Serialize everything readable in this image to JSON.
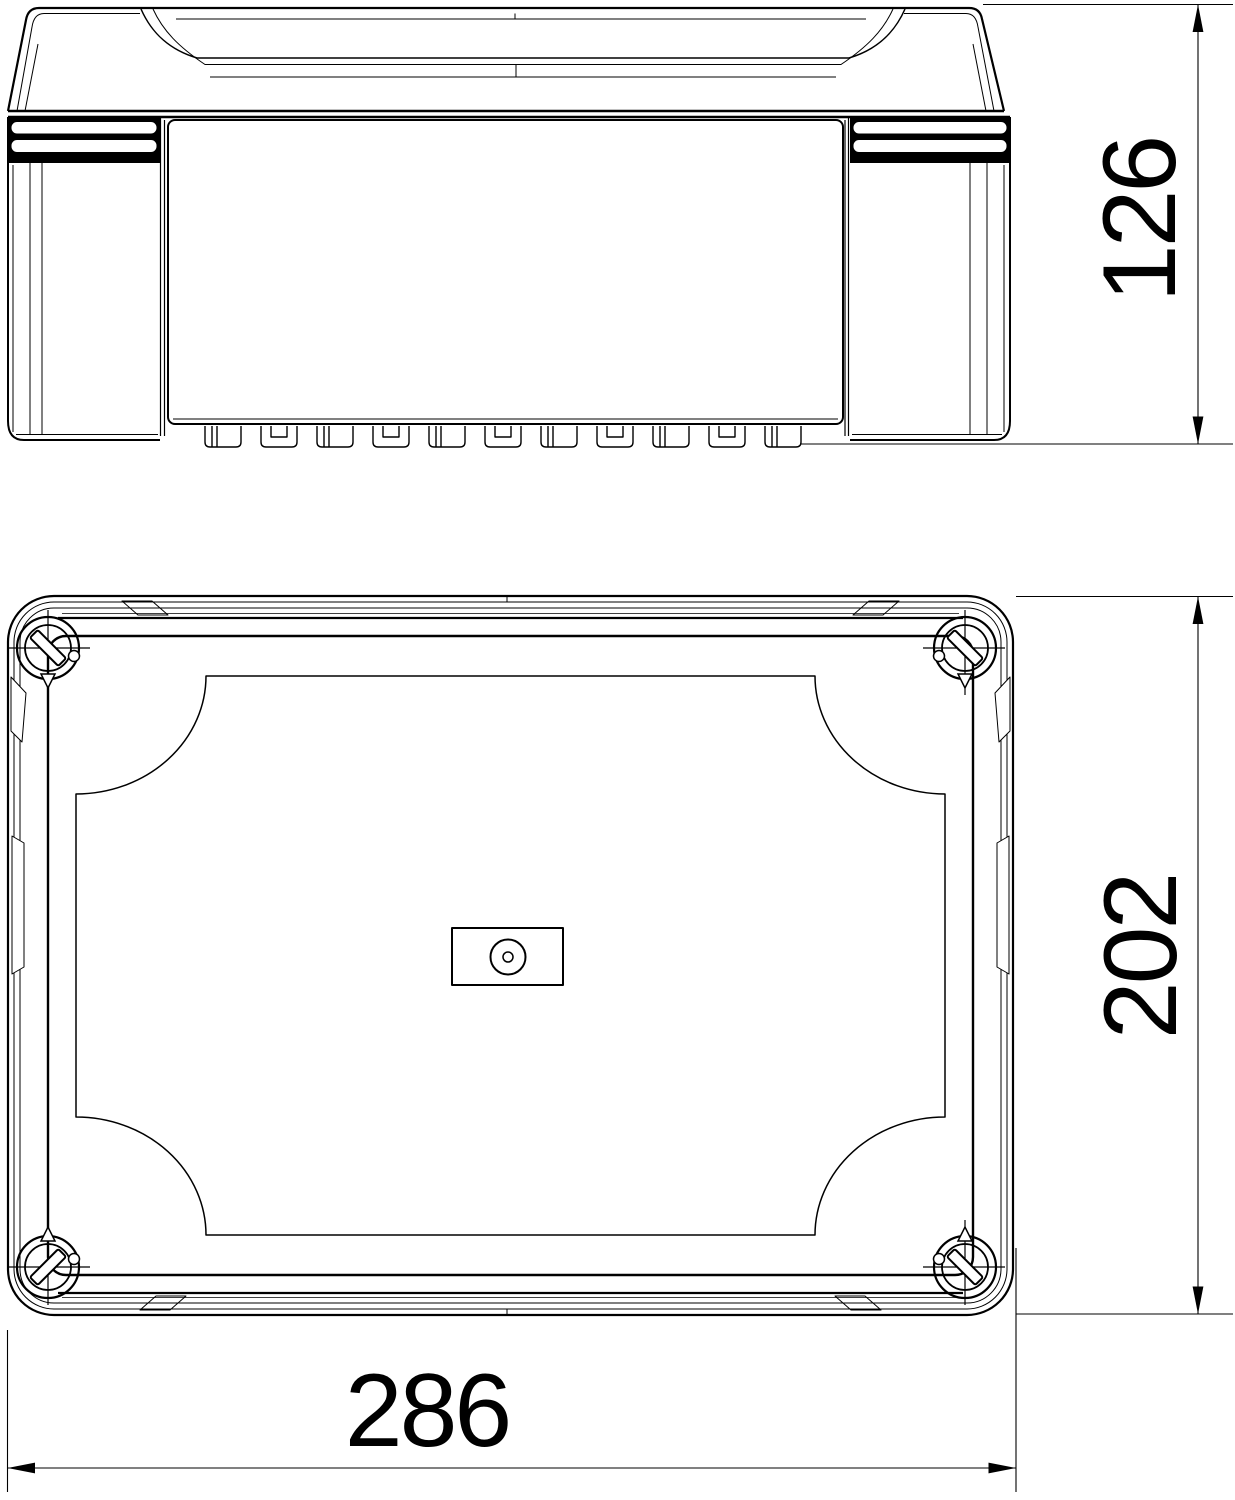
{
  "colors": {
    "line": "#000000",
    "background": "#ffffff"
  },
  "views": {
    "front": {
      "name": "front elevation of enclosure"
    },
    "plan": {
      "name": "plan view of enclosure cover"
    }
  },
  "dimensions": {
    "height": {
      "value": "126"
    },
    "depth": {
      "value": "202"
    },
    "width": {
      "value": "286"
    }
  }
}
